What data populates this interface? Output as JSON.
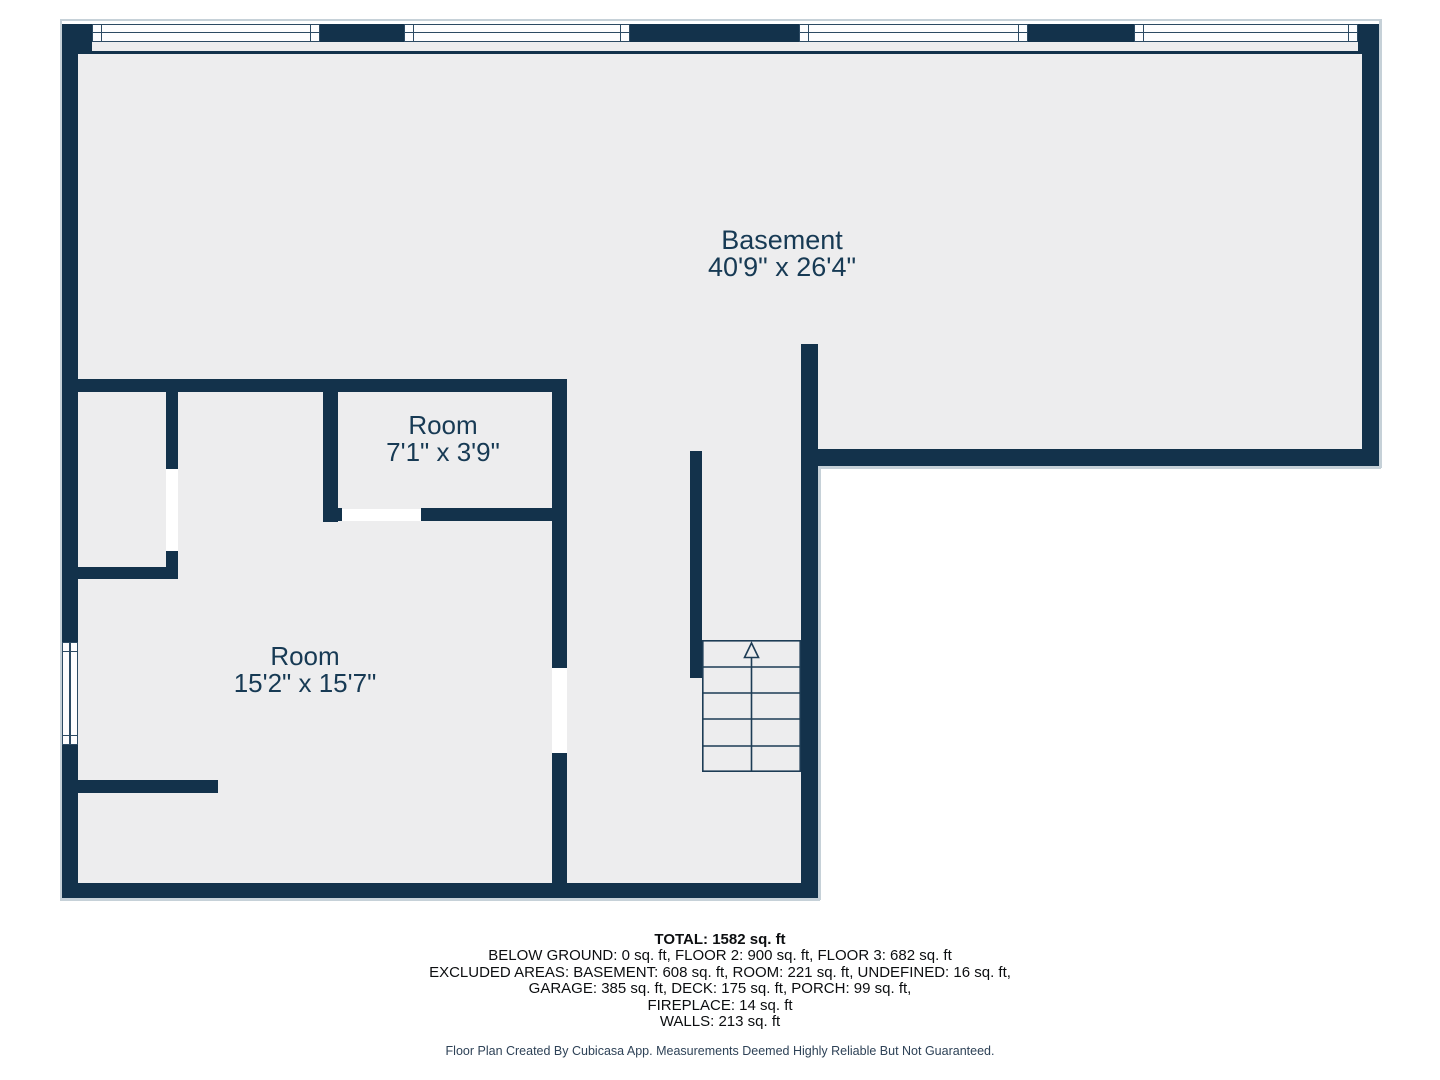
{
  "colors": {
    "wall": "#13324b",
    "floor": "#ededee",
    "label": "#173a54",
    "stairline": "#1d3c55",
    "text": "#0c0e10",
    "footertext": "#2e4257",
    "winframe": "#2c4a63",
    "outline": "#c6d1d8"
  },
  "rooms": [
    {
      "name": "Basement",
      "dimensions": "40'9\" x 26'4\""
    },
    {
      "name": "Room",
      "dimensions": "7'1\" x 3'9\""
    },
    {
      "name": "Room",
      "dimensions": "15'2\" x 15'7\""
    }
  ],
  "summary": {
    "total": "TOTAL: 1582 sq. ft",
    "lines": [
      "BELOW GROUND: 0 sq. ft, FLOOR 2: 900 sq. ft, FLOOR 3: 682 sq. ft",
      "EXCLUDED AREAS: BASEMENT: 608 sq. ft, ROOM: 221 sq. ft, UNDEFINED: 16 sq. ft,",
      "GARAGE: 385 sq. ft, DECK: 175 sq. ft, PORCH: 99 sq. ft,",
      "FIREPLACE: 14 sq. ft",
      "WALLS: 213 sq. ft"
    ]
  },
  "footer": "Floor Plan Created By Cubicasa App. Measurements Deemed Highly Reliable But Not Guaranteed."
}
